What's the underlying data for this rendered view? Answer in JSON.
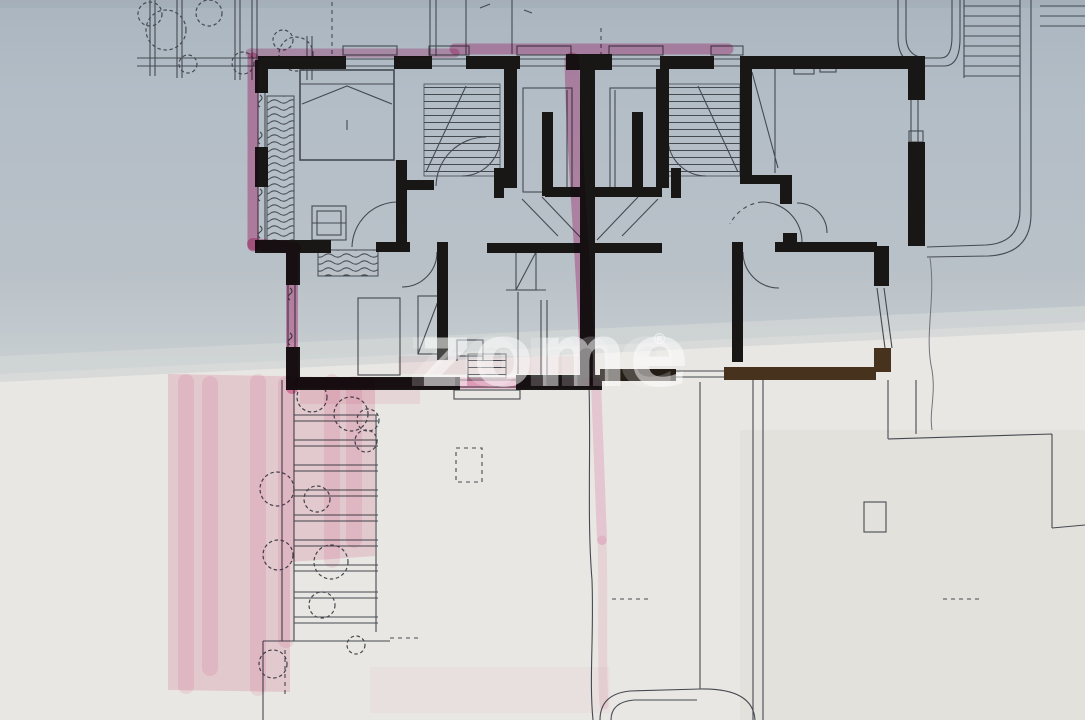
{
  "watermark": {
    "text": "zome",
    "registered": "®"
  },
  "palette": {
    "photo_top": "#adb8c2",
    "photo_mid": "#b6bfc7",
    "photo_low": "#c6ccd0",
    "photo_band": "#d2d5d5",
    "paper": "#e9e7e3",
    "paper_shade": "#dedcd7",
    "ink": "#454a51",
    "ink_soft": "#70747a",
    "wall": "#181716",
    "wall_brown": "#47321d",
    "pink": "#e2579b",
    "pink_light": "#f0b6cc",
    "watermark": "#ffffff"
  }
}
